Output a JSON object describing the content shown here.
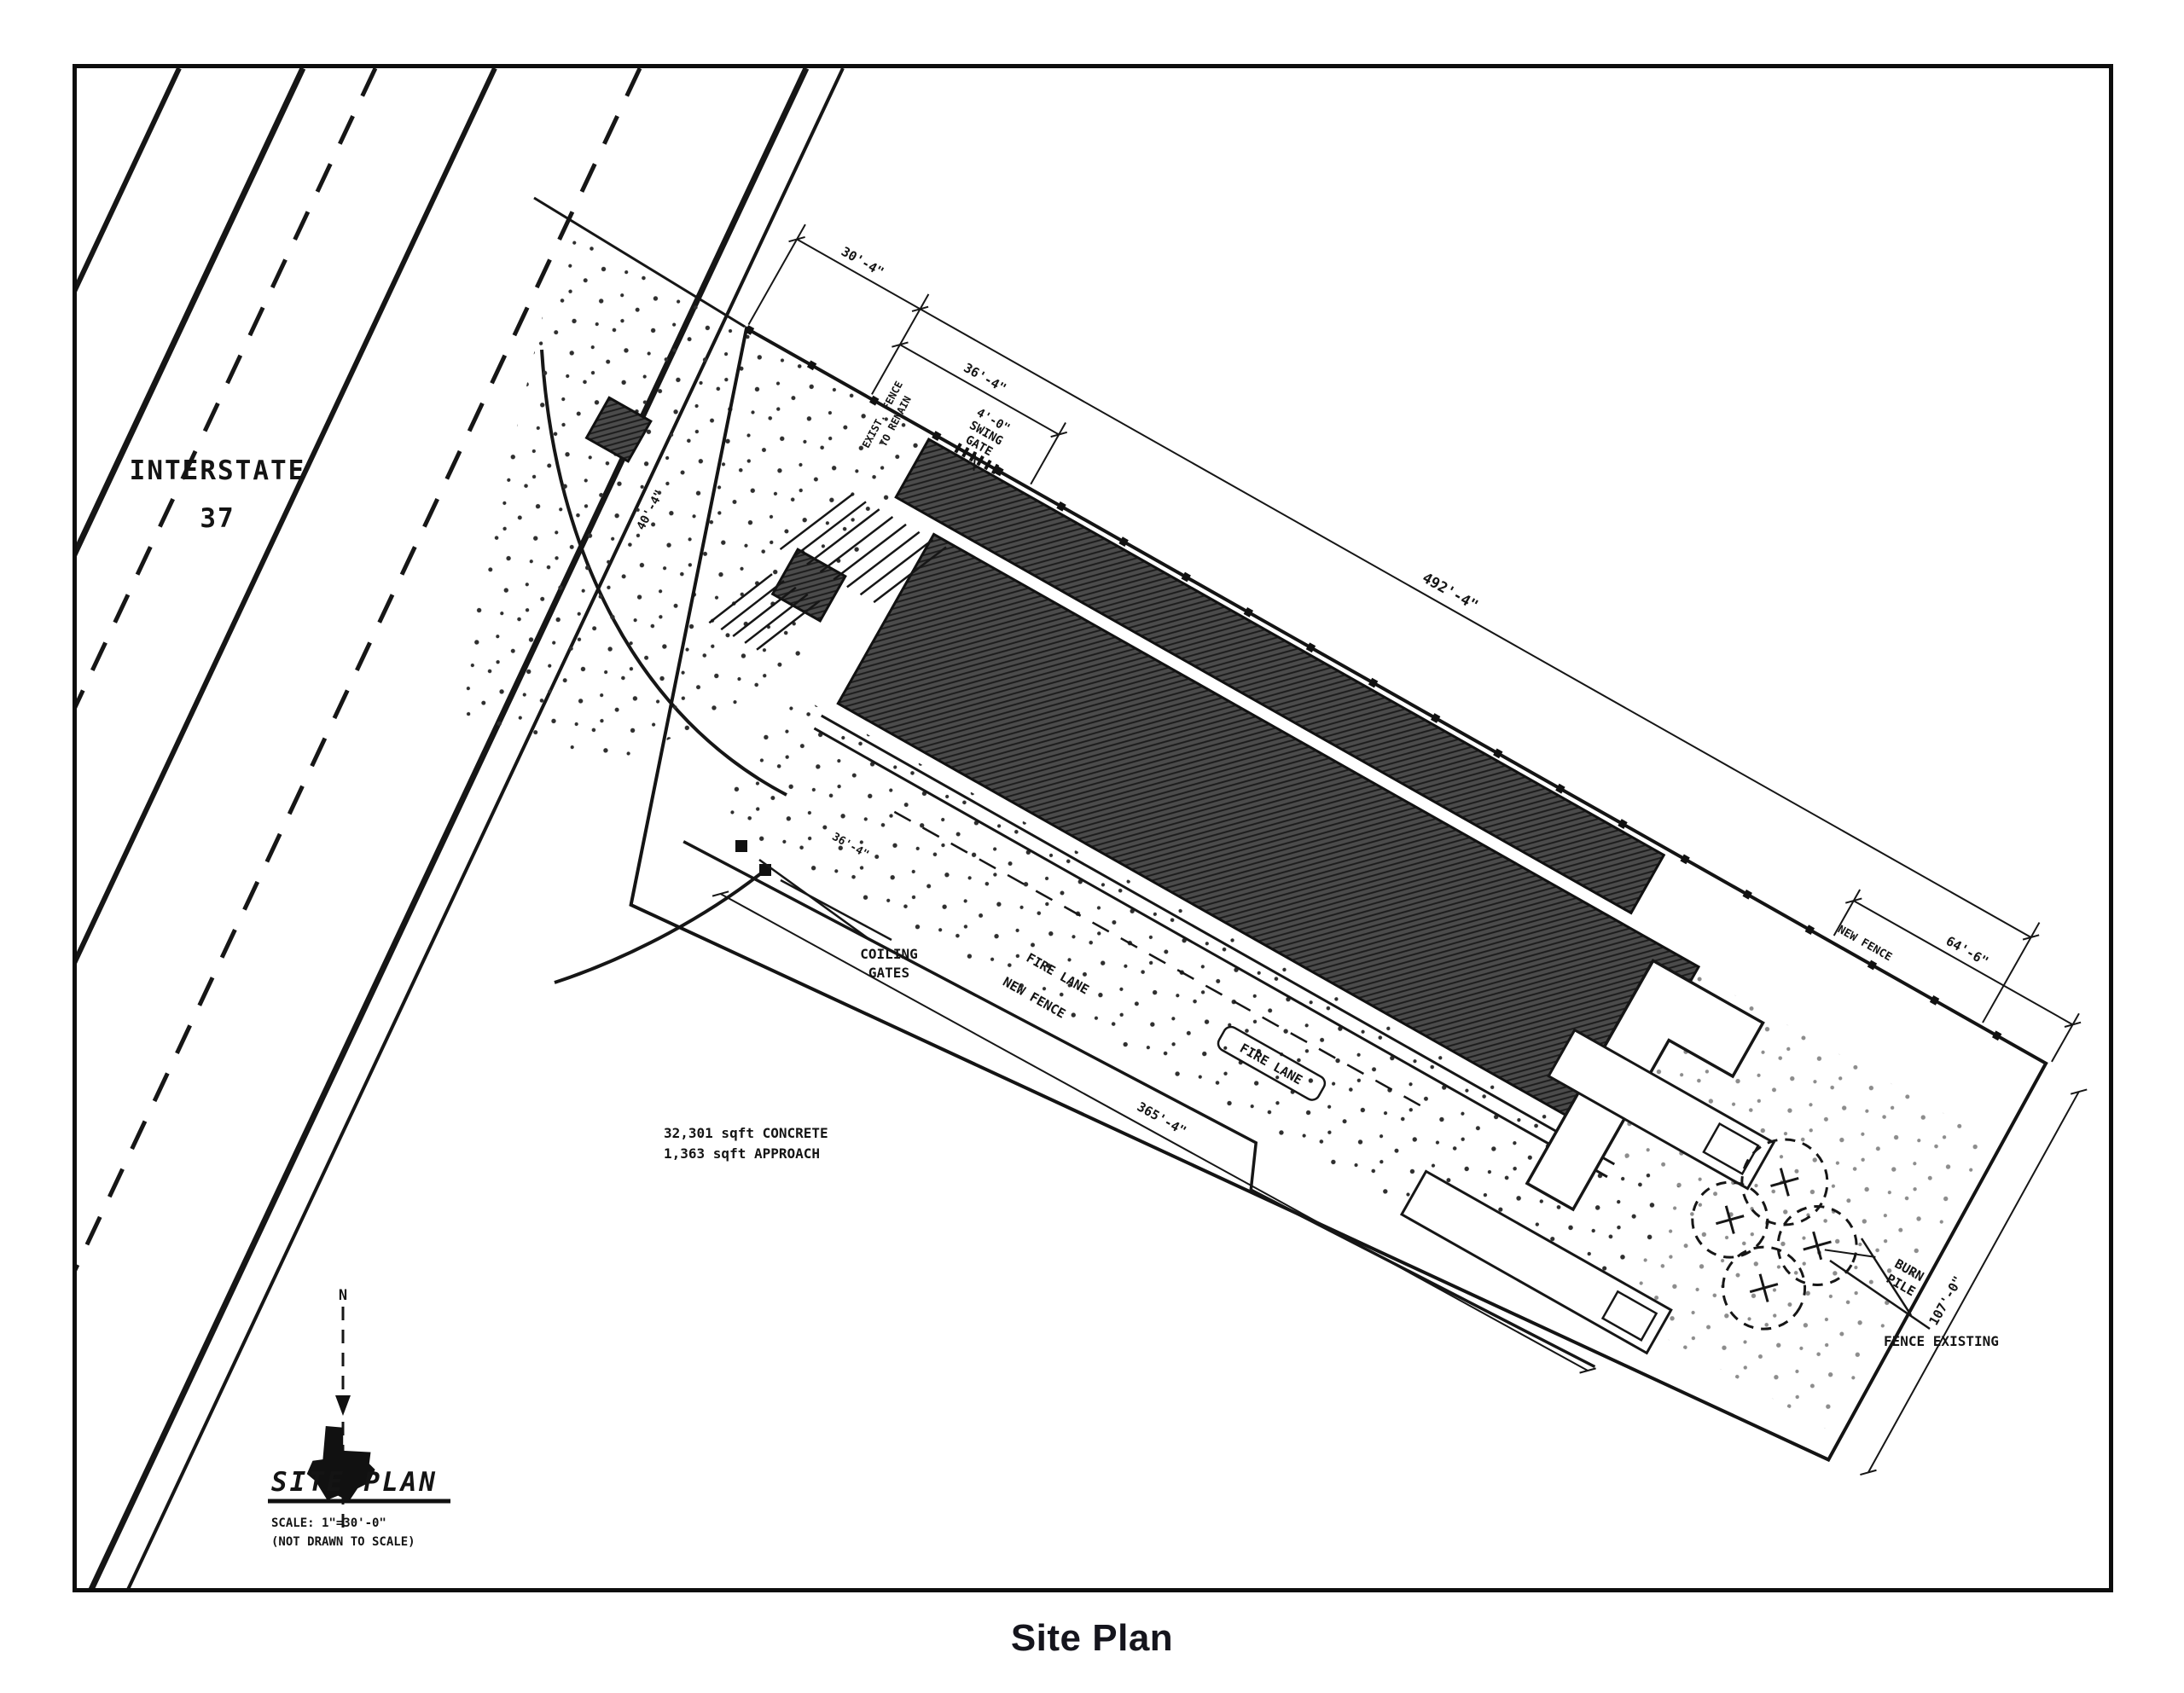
{
  "page": {
    "caption": "Site Plan"
  },
  "highway": {
    "line1": "INTERSTATE",
    "line2": "37"
  },
  "titleBlock": {
    "north": "N",
    "title": "SITE PLAN",
    "scale1": "SCALE: 1\"=30'-0\"",
    "scale2": "(NOT DRAWN TO SCALE)"
  },
  "dims": {
    "d30": "30'-4\"",
    "d36": "36'-4\"",
    "d36b": "36'-4\"",
    "d40": "40'-4\"",
    "d492": "492'-4\"",
    "d365": "365'-4\"",
    "d64": "64'-6\"",
    "d107": "107'-0\""
  },
  "labels": {
    "swing1": "4'-0\"",
    "swing2": "SWING",
    "swing3": "GATE",
    "existFence1": "EXIST. FENCE",
    "existFence2": "TO REMAIN",
    "coiling1": "COILING",
    "coiling2": "GATES",
    "concrete1": "32,301 sqft CONCRETE",
    "concrete2": "1,363 sqft APPROACH",
    "newFenceA": "NEW FENCE",
    "newFenceB": "NEW FENCE",
    "fireLaneA": "FIRE LANE",
    "fireLaneB": "FIRE LANE",
    "burn1": "BURN",
    "burn2": "PILE",
    "fenceExisting": "FENCE EXISTING"
  }
}
